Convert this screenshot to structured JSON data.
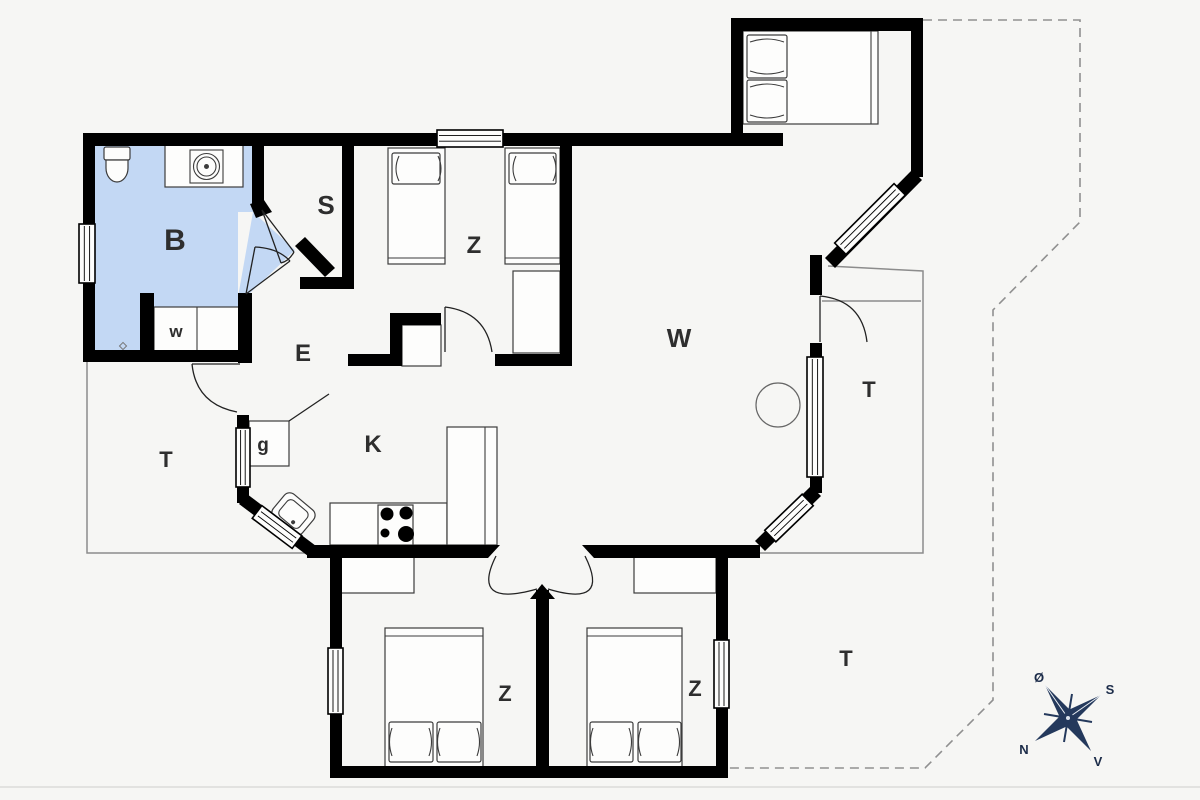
{
  "plan": {
    "rooms": {
      "bathroom": "B",
      "storage": "S",
      "bedroom_top": "Z",
      "living_room": "W",
      "entry": "E",
      "washer": "w",
      "cupboard": "g",
      "kitchen": "K",
      "terrace_west": "T",
      "terrace_east": "T",
      "terrace_south": "T",
      "bedroom_south_left": "Z",
      "bedroom_south_right": "Z"
    },
    "compass": {
      "north": "N",
      "south": "S",
      "east": "Ø",
      "west": "V"
    },
    "colors": {
      "wall": "#000000",
      "bathroom_fill": "#c3d8f4",
      "compass": "#24395c",
      "terrace_line": "#8c8c8c",
      "background": "#f6f6f4"
    }
  }
}
